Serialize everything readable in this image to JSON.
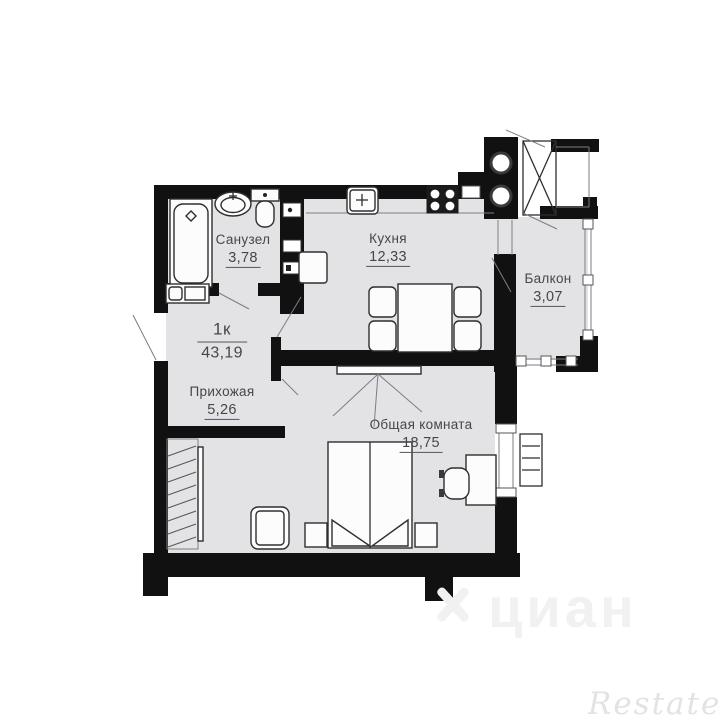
{
  "unit": {
    "rooms_label": "1к",
    "total_area": "43,19"
  },
  "rooms": {
    "bathroom": {
      "name": "Санузел",
      "area": "3,78"
    },
    "kitchen": {
      "name": "Кухня",
      "area": "12,33"
    },
    "balcony": {
      "name": "Балкон",
      "area": "3,07"
    },
    "hallway": {
      "name": "Прихожая",
      "area": "5,26"
    },
    "living": {
      "name": "Общая комната",
      "area": "18,75"
    }
  },
  "fixtures": [
    "bathtub-icon",
    "washbasin-icon",
    "toilet-icon",
    "washing-machine-icon",
    "kitchen-sink-icon",
    "stove-icon",
    "fridge-icon",
    "dining-table-icon",
    "chair-icon",
    "tv-icon",
    "double-bed-icon",
    "nightstand-icon",
    "desk-icon",
    "desk-chair-icon",
    "armchair-icon",
    "wardrobe-icon",
    "radiator-icon",
    "pipe-riser-icon",
    "vent-shaft-icon"
  ],
  "watermarks": {
    "cian": "циан",
    "restate": "Restate"
  },
  "colors": {
    "wall": "#111111",
    "floor": "#e3e3e6",
    "outline": "#2e2e2e",
    "label_text": "#45454c",
    "watermark": "#f1f1f1",
    "restate_watermark": "#e3e3e5"
  }
}
